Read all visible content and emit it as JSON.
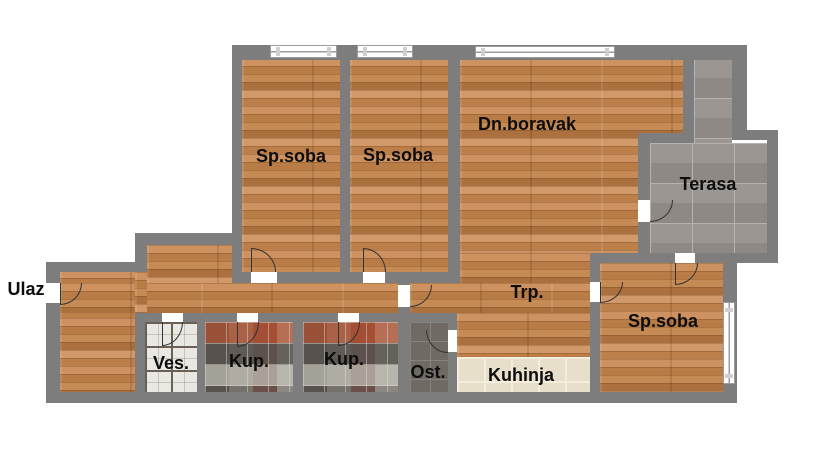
{
  "rooms": {
    "spsoba1": {
      "label": "Sp.soba"
    },
    "spsoba2": {
      "label": "Sp.soba"
    },
    "boravak": {
      "label": "Dn.boravak"
    },
    "terasa": {
      "label": "Terasa"
    },
    "trp": {
      "label": "Trp."
    },
    "spsoba3": {
      "label": "Sp.soba"
    },
    "ves": {
      "label": "Ves."
    },
    "kup1": {
      "label": "Kup."
    },
    "kup2": {
      "label": "Kup."
    },
    "ost": {
      "label": "Ost."
    },
    "kuhinja": {
      "label": "Kuhinja"
    },
    "entrance": {
      "label": "Ulaz"
    }
  },
  "colors": {
    "wall": "#7d7d7d",
    "label_text": "#0d0d0d",
    "window_frame": "#9b9b9b",
    "door_arc": "#333333",
    "background": "#ffffff",
    "wood_floor": "#c1854f",
    "terrace_tile": "#96908c",
    "bathroom_tile": "#6e6862",
    "laundry_tile": "#eae8e3",
    "storage_tile": "#6f6a64",
    "kitchen_tile": "#e7dfca"
  }
}
